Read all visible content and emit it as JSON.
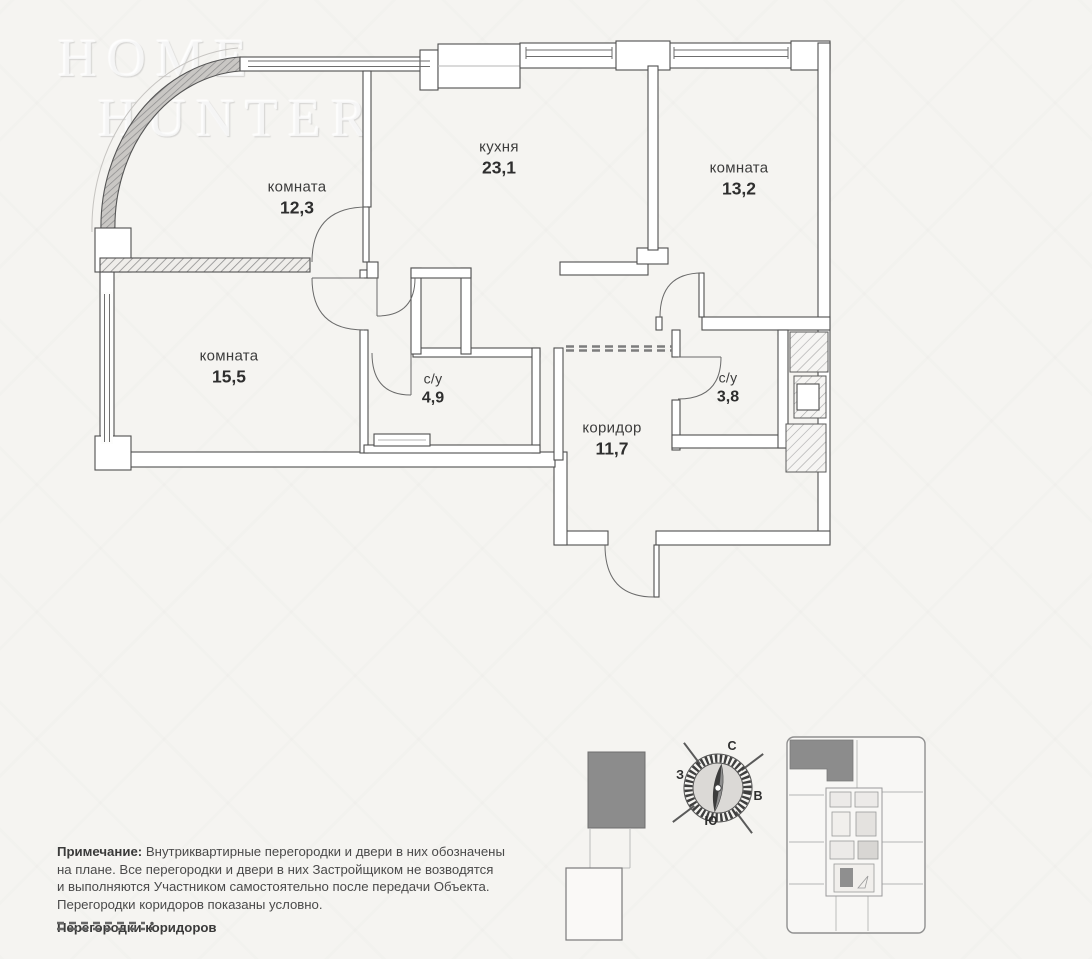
{
  "watermark": {
    "line1": "Home",
    "line2": "Hunter"
  },
  "plan": {
    "rooms": [
      {
        "id": "room-1",
        "name": "комната",
        "area": "12,3"
      },
      {
        "id": "kitchen",
        "name": "кухня",
        "area": "23,1"
      },
      {
        "id": "room-2",
        "name": "комната",
        "area": "13,2"
      },
      {
        "id": "room-3",
        "name": "комната",
        "area": "15,5"
      },
      {
        "id": "bathroom-1",
        "name": "с/у",
        "area": "4,9"
      },
      {
        "id": "bathroom-2",
        "name": "с/у",
        "area": "3,8"
      },
      {
        "id": "corridor",
        "name": "коридор",
        "area": "11,7"
      }
    ]
  },
  "compass": {
    "north": "С",
    "south": "Ю",
    "west": "З",
    "east": "В"
  },
  "note": {
    "title": "Примечание:",
    "line1": "Внутриквартирные перегородки и двери в них обозначены",
    "line2": "на плане. Все перегородки и двери в них Застройщиком не возводятся",
    "line3": "и выполняются Участником самостоятельно после передачи Объекта.",
    "line4": "Перегородки коридоров показаны условно."
  },
  "legend": {
    "label": "Перегородки коридоров"
  },
  "colors": {
    "paper": "#f5f4f1",
    "wall_line": "#4f4f4f",
    "highlight_unit": "#8c8c8c",
    "text": "#3c3c3c"
  }
}
